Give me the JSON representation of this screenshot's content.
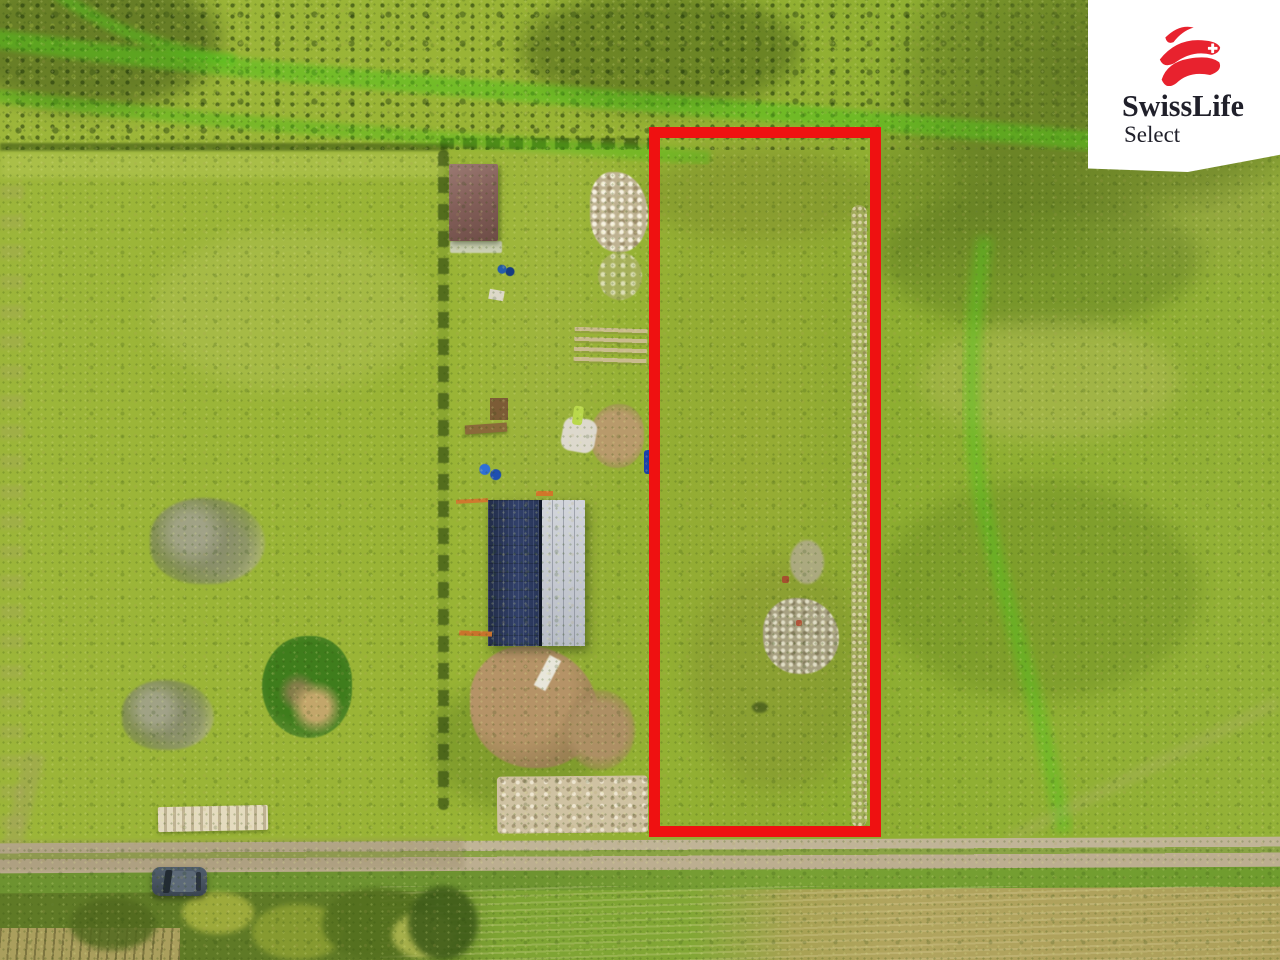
{
  "canvas": {
    "width": 1280,
    "height": 960
  },
  "watermark": {
    "brand": "SwissLife",
    "subbrand": "Select",
    "mark": "swisslife-swoosh-with-swiss-cross",
    "bg": "#ffffff",
    "text_color": "#20202a",
    "accent": "#e8222e"
  },
  "highlight": {
    "type": "parcel-boundary-outline",
    "color": "#ef1111",
    "stroke_px": 11,
    "bbox_px": {
      "left": 649,
      "top": 127,
      "width": 232,
      "height": 710
    }
  },
  "scene": {
    "type": "aerial-drone-photo",
    "subject": "grassy-land-plot-for-sale-with-outlined-parcel",
    "elements": [
      "meadow",
      "scrub-band-top",
      "bright-grass-paths",
      "garden-plot",
      "brown-roof-shed",
      "two-tone-roof-barn",
      "rubble-pile",
      "lumber-planks",
      "dirt-patch",
      "sand-patch",
      "inner-gravel-strip",
      "debris-patch",
      "gravel-road",
      "road-verge",
      "mown-dry-field",
      "plank-stack",
      "parked-car",
      "tree-scrub-patches",
      "green-bush",
      "curving-grass-trail"
    ],
    "colors": {
      "meadow": "#9ab236",
      "meadow_right": "#8cae33",
      "scrub": "#66811f",
      "path_green": "#55c31c",
      "shed_roof": "#84605a",
      "barn_roof_dark": "#2c3a5c",
      "barn_roof_light": "#c9cdd4",
      "dirt": "#b59367",
      "sand": "#cfc2a2",
      "road": "#b8ab8d",
      "dry_field": "#b1a45e",
      "car": "#4b5766"
    }
  }
}
